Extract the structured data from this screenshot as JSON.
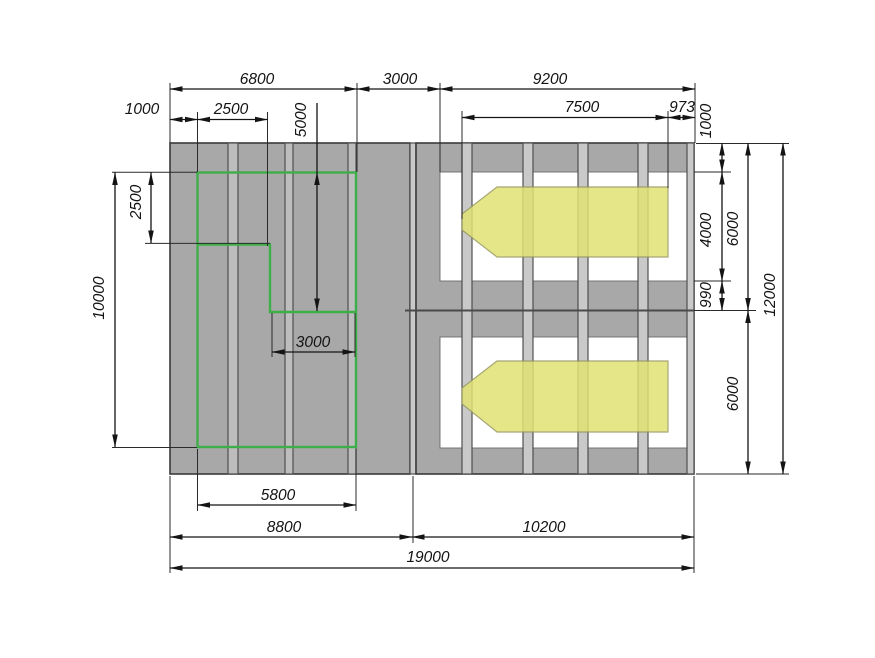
{
  "drawing": {
    "dimensions": {
      "top_6800": "6800",
      "top_3000": "3000",
      "top_9200": "9200",
      "top_1000": "1000",
      "top_2500": "2500",
      "top_7500": "7500",
      "top_973": "973",
      "left_2500": "2500",
      "left_10000": "10000",
      "left_5000": "5000",
      "inner_3000": "3000",
      "right_1000": "1000",
      "right_4000": "4000",
      "right_990": "990",
      "right_6000_upper": "6000",
      "right_6000_lower": "6000",
      "right_12000": "12000",
      "bottom_5800": "5800",
      "bottom_8800": "8800",
      "bottom_10200": "10200",
      "bottom_19000": "19000"
    },
    "colors": {
      "building_gray": "#a8a8a8",
      "strip_gray": "#c9c9c9",
      "zone_green": "#3eae49",
      "vehicle_yellow": "#e0e273"
    }
  }
}
